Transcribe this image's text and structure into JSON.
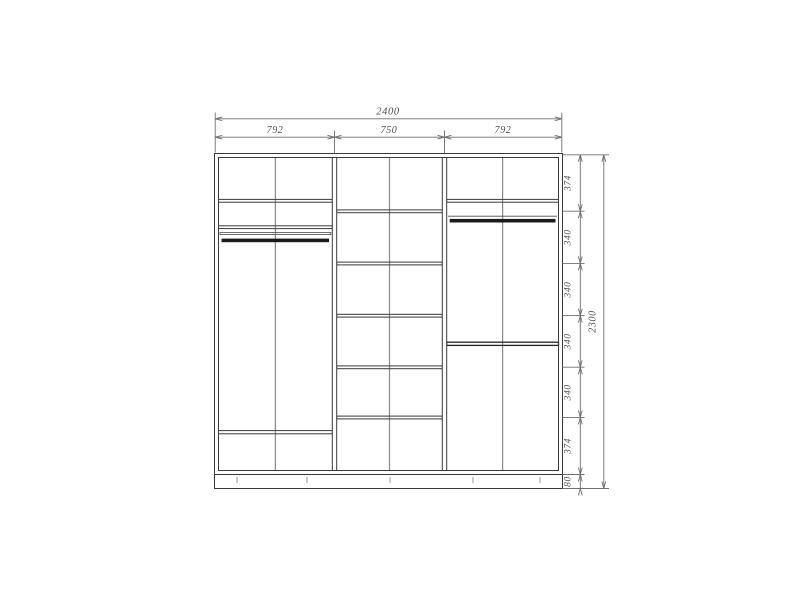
{
  "drawing": {
    "type": "technical-drawing",
    "subject": "wardrobe front elevation with shelves and hanging rods",
    "background": "#ffffff",
    "colors": {
      "structure_line": "#3a3a3a",
      "center_divider_line": "#8b8b8b",
      "hanging_rod_fill": "#1b1b1b",
      "dimension_line": "#6f6f6f",
      "dimension_text": "#4f4f4f"
    },
    "dimensions": {
      "top": {
        "total": "2400",
        "sections": [
          "792",
          "750",
          "792"
        ]
      },
      "right": {
        "segments": [
          "374",
          "340",
          "340",
          "340",
          "340",
          "374",
          "80"
        ],
        "total": "2300"
      }
    }
  }
}
